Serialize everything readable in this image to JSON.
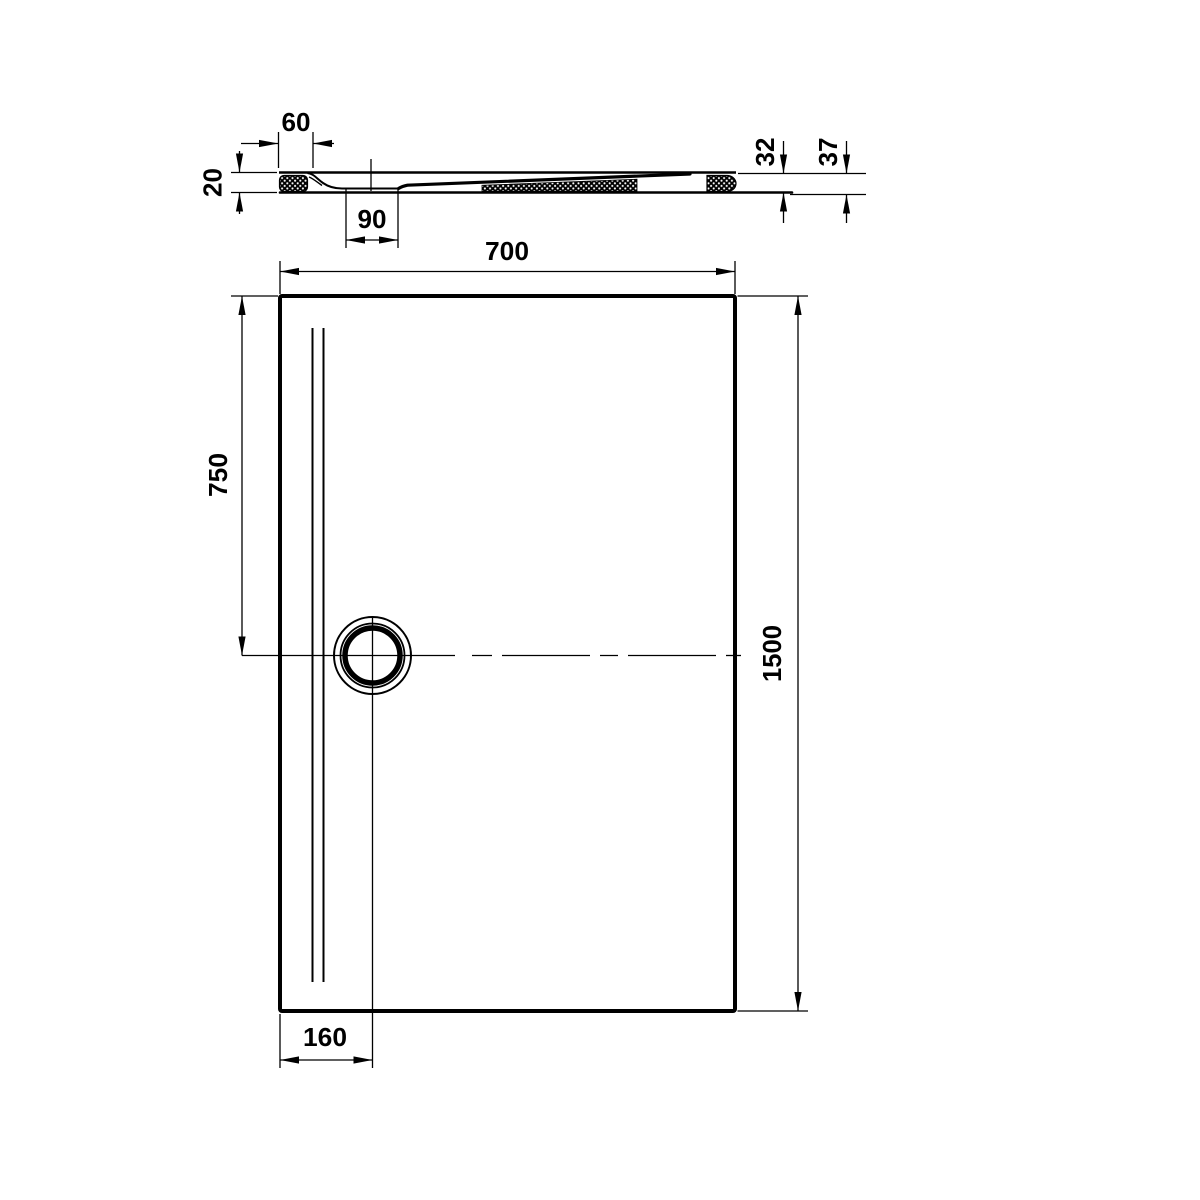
{
  "colors": {
    "ink": "#000000",
    "background": "#ffffff"
  },
  "section_view": {
    "dim_rim_width": "60",
    "dim_rim_height": "20",
    "dim_drain_channel_width": "90",
    "dim_edge_height": "32",
    "dim_total_height": "37"
  },
  "plan_view": {
    "dim_width": "700",
    "dim_length": "1500",
    "dim_drain_center_from_top": "750",
    "dim_drain_center_from_left": "160"
  }
}
